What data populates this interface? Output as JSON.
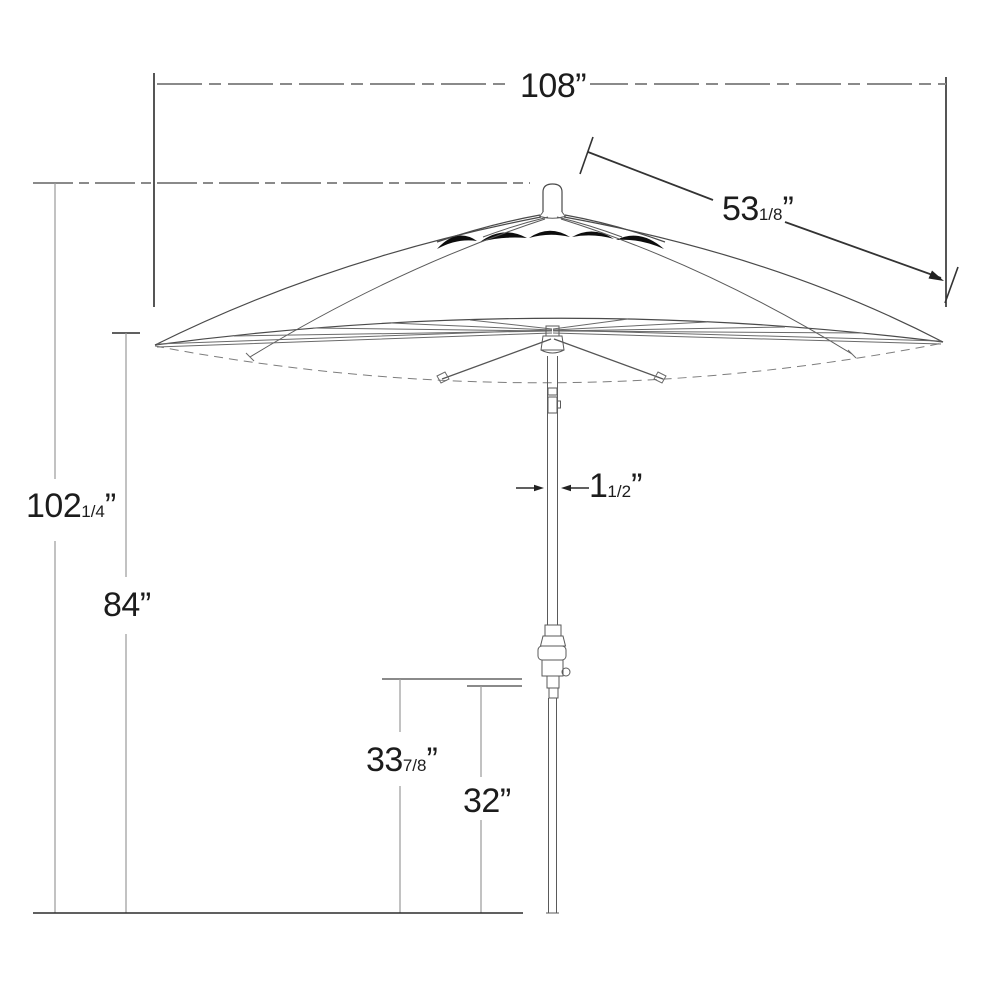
{
  "figure": {
    "type": "patio-umbrella-dimension-diagram",
    "dims": {
      "canopy_width": {
        "whole": "108",
        "frac": "",
        "unit": "”"
      },
      "rib_length": {
        "whole": "53",
        "frac": "1/8",
        "unit": "”"
      },
      "total_height": {
        "whole": "102",
        "frac": "1/4",
        "unit": "”"
      },
      "hub_height": {
        "whole": "84",
        "frac": "",
        "unit": "”"
      },
      "pole_diameter": {
        "whole": "1",
        "frac": "1/2",
        "unit": "”"
      },
      "crank_top": {
        "whole": "33",
        "frac": "7/8",
        "unit": "”"
      },
      "crank_bottom": {
        "whole": "32",
        "frac": "",
        "unit": "”"
      }
    }
  }
}
